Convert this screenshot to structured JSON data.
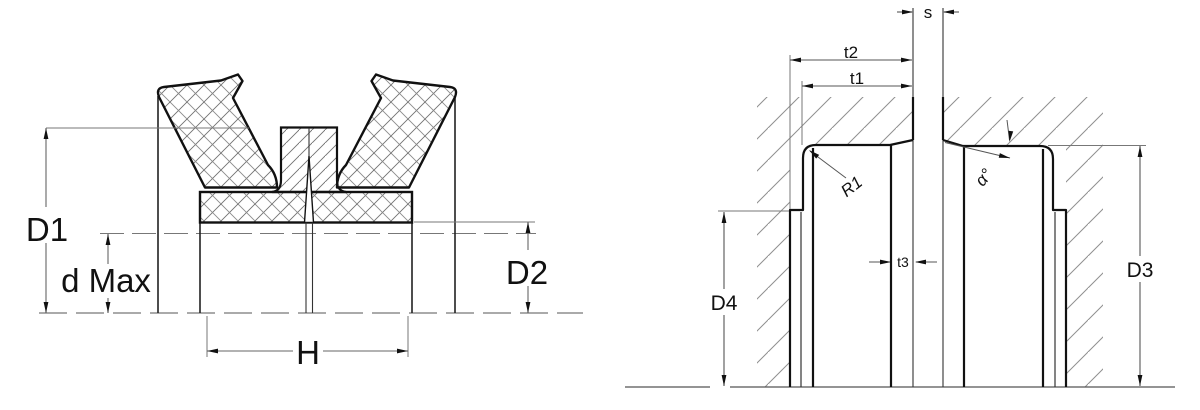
{
  "diagram": {
    "left_figure": {
      "labels": {
        "d1": "D1",
        "d_max": "d Max",
        "d2": "D2",
        "h": "H"
      }
    },
    "right_figure": {
      "labels": {
        "s": "s",
        "t2": "t2",
        "t1": "t1",
        "t3": "t3",
        "r1": "R1",
        "alpha": "α°",
        "d3": "D3",
        "d4": "D4"
      }
    },
    "colors": {
      "outline": "#111111",
      "thin_line": "#555555",
      "extension_line": "#777777",
      "hatch_seal": "#6f6f6f",
      "hatch_housing": "#8f8f8f",
      "background": "#ffffff"
    }
  }
}
